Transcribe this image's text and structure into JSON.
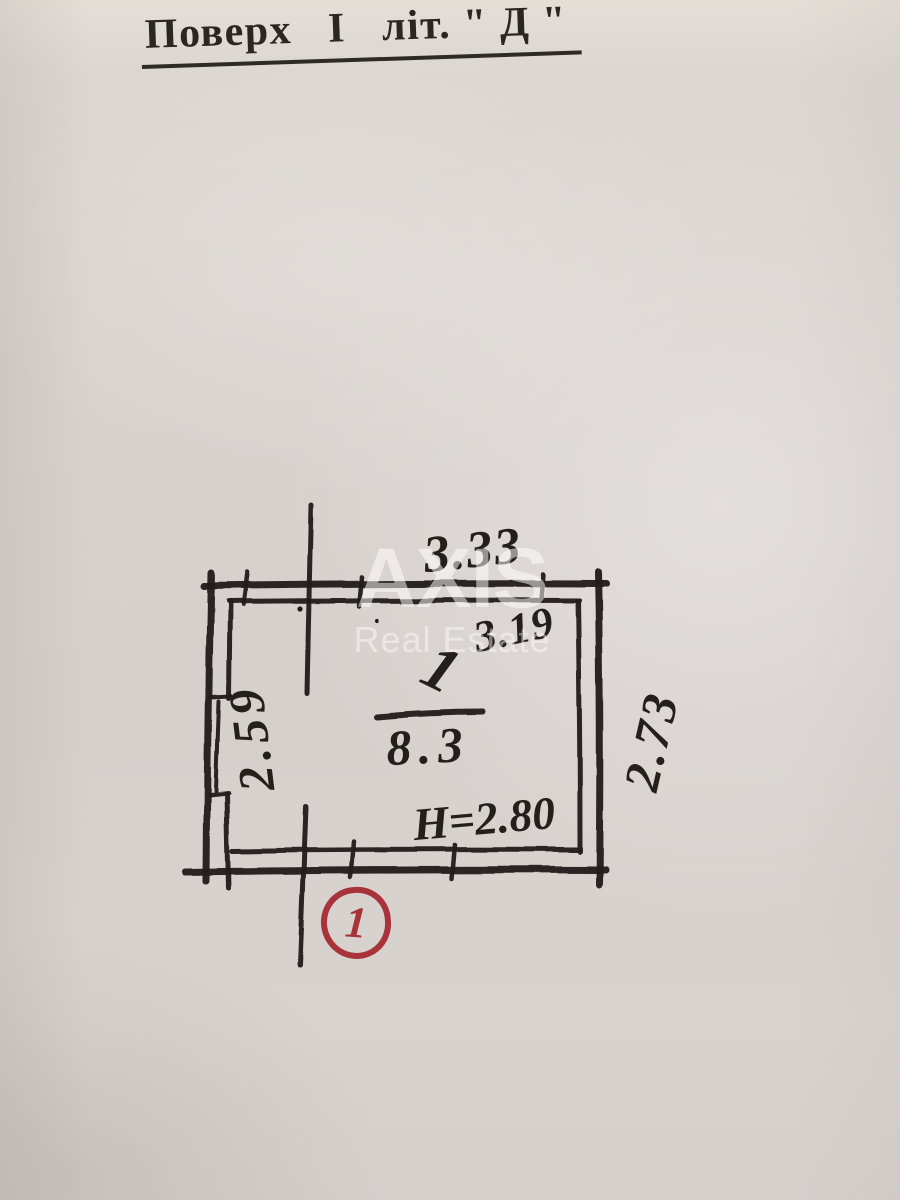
{
  "page": {
    "title": "Поверх   І   літ. \" Д \""
  },
  "watermark": {
    "line1": "AXIS",
    "line2": "Real Estate"
  },
  "plan": {
    "dim_top_outer": "3.33",
    "dim_top_inner": "3.19",
    "dim_left": "2.59",
    "dim_right": "2.73",
    "room_number": "1",
    "room_area": "8.3",
    "ceiling_height": "Н=2.80",
    "room_badge": "1"
  },
  "colors": {
    "ink": "#23201c",
    "red": "#a8333b",
    "paper": "#d8d2ce",
    "watermark_white": "#ffffff"
  }
}
